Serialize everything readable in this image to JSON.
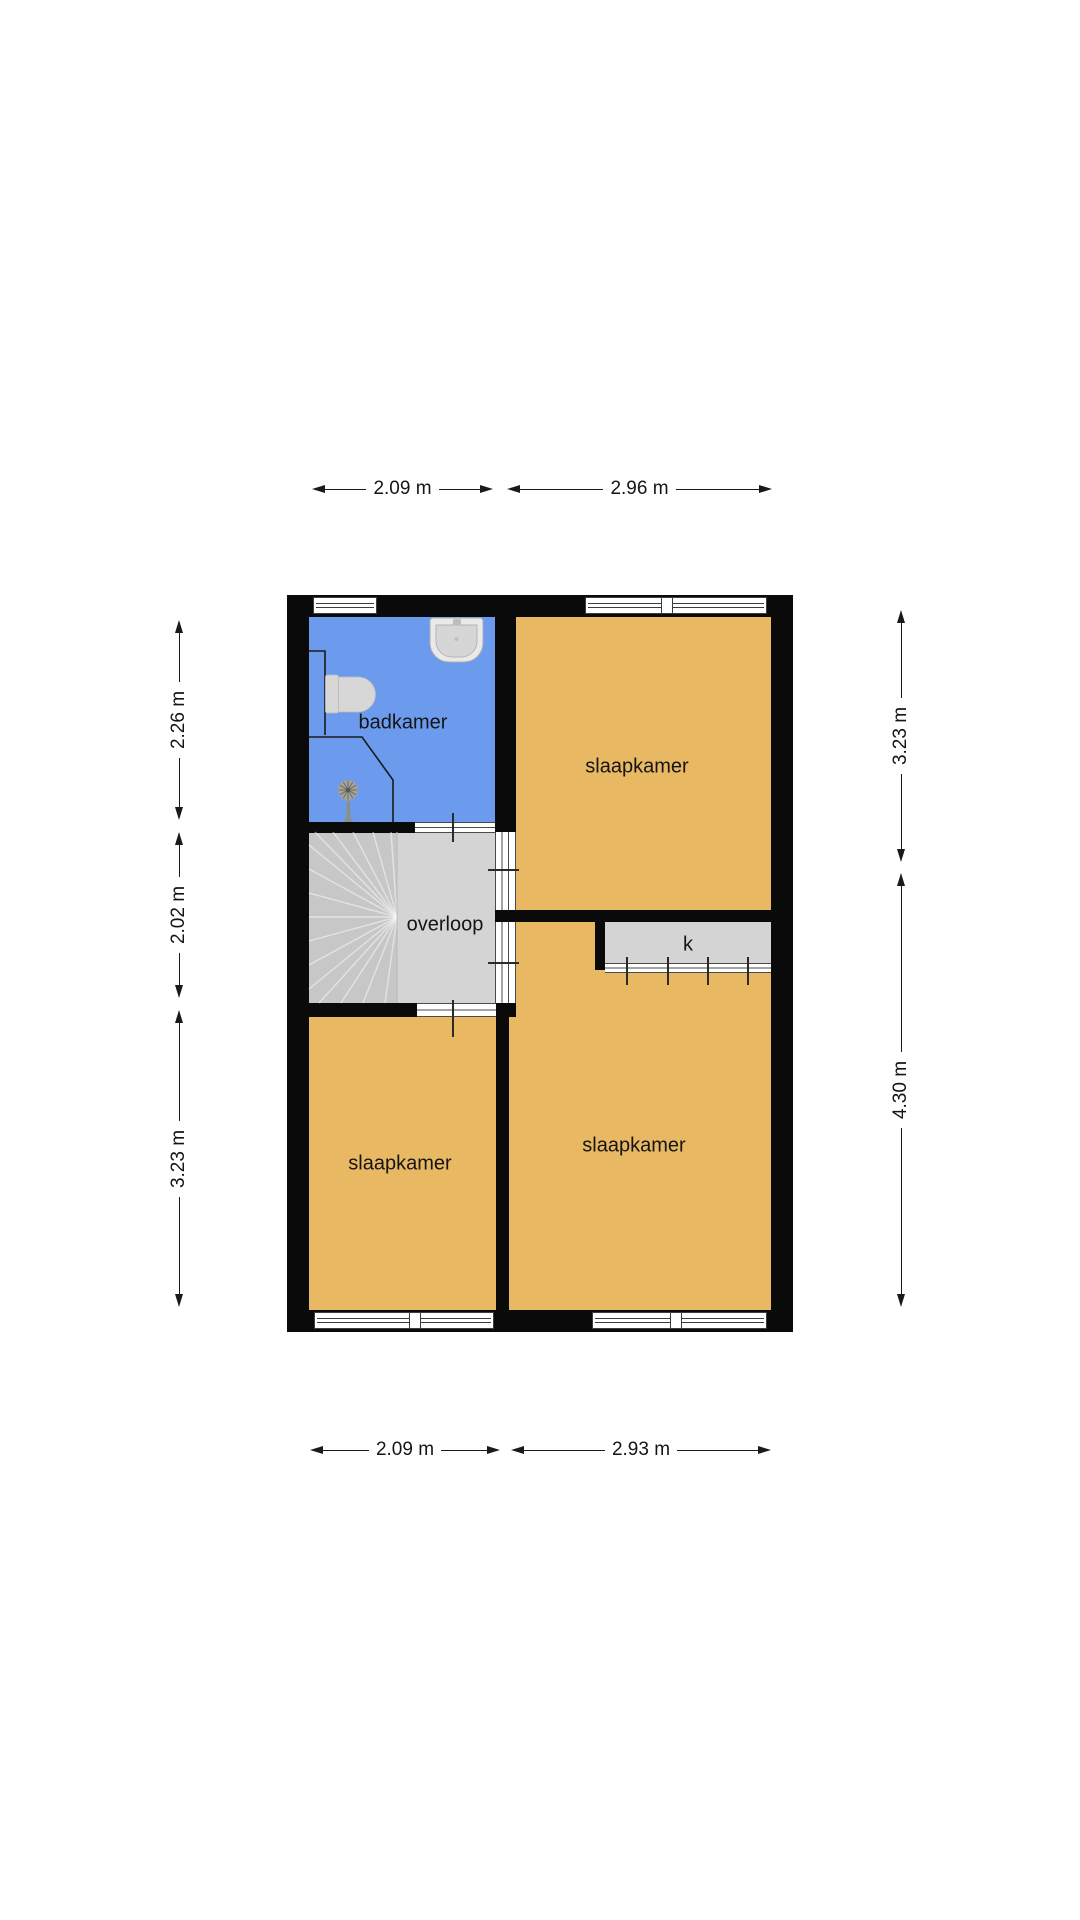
{
  "plan": {
    "rooms": {
      "badkamer": "badkamer",
      "slaapkamer_top": "slaapkamer",
      "overloop": "overloop",
      "kast": "k",
      "slaapkamer_bottom_left": "slaapkamer",
      "slaapkamer_bottom_right": "slaapkamer"
    },
    "fixtures": [
      "sink",
      "toilet",
      "shower-head"
    ],
    "colors": {
      "bedroom": "#e9b863",
      "bathroom": "#6c9bee",
      "circulation": "#d4d4d4",
      "stairs": "#c7c7c7",
      "wall": "#0a0a0a"
    }
  },
  "dimensions": {
    "top": [
      "2.09 m",
      "2.96 m"
    ],
    "bottom": [
      "2.09 m",
      "2.93 m"
    ],
    "left": [
      "2.26 m",
      "2.02 m",
      "3.23 m"
    ],
    "right": [
      "3.23 m",
      "4.30 m"
    ]
  }
}
